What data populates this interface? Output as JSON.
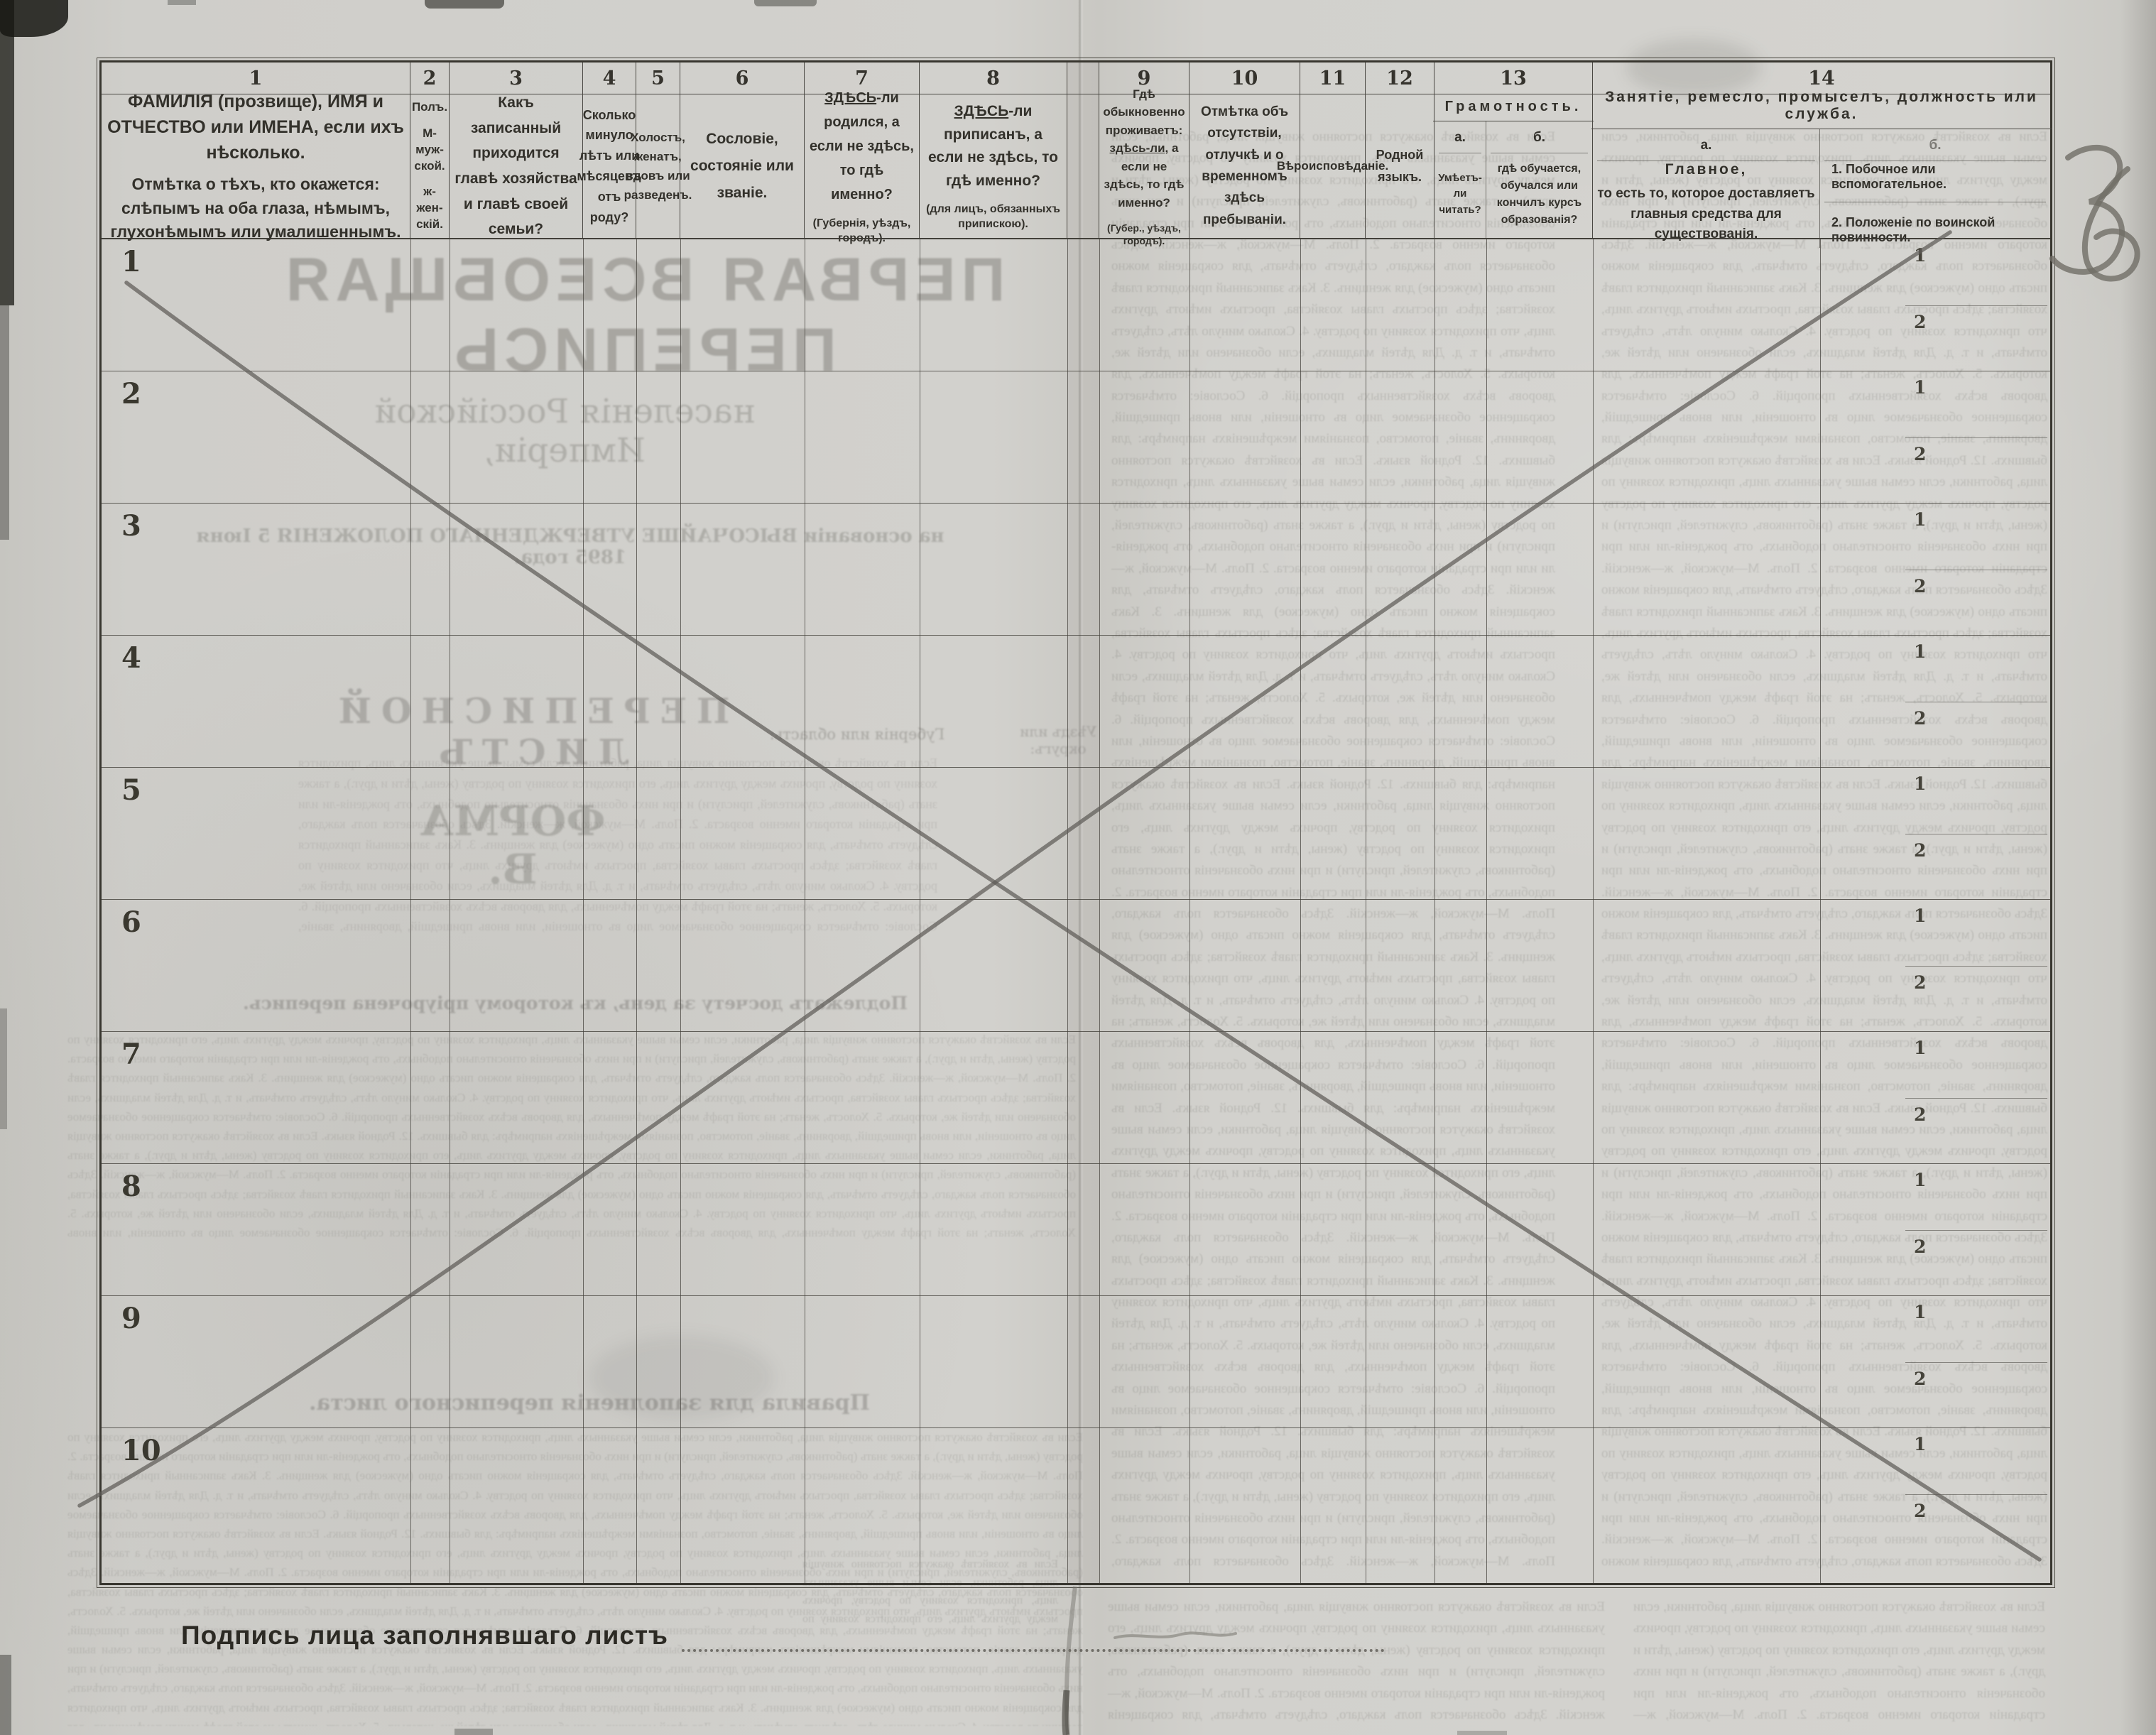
{
  "document": {
    "handwritten_page_number": "36",
    "signature_line_label": "Подпись лица заполнявшаго листъ",
    "colors": {
      "paper": "#cfceca",
      "ink": "#2e2c28",
      "table_line": "#4a4843",
      "pencil": "#6b6964"
    },
    "table": {
      "row_numbers": [
        "1",
        "2",
        "3",
        "4",
        "5",
        "6",
        "7",
        "8",
        "9",
        "10"
      ],
      "occupation_sub_labels": [
        "1",
        "2"
      ],
      "columns": [
        {
          "num": "1",
          "title_1": "ФАМИЛІЯ (прозвище), ИМЯ и ОТЧЕСТВО или ИМЕНА, если ихъ нѣсколько.",
          "title_2": "Отмѣтка о тѣхъ, кто окажется: слѣпымъ на оба глаза, нѣмымъ, глухонѣмымъ или умалишеннымъ."
        },
        {
          "num": "2",
          "line_1": "Полъ.",
          "line_2": "М-муж-ской.",
          "line_3": "ж-жен-скій."
        },
        {
          "num": "3",
          "title": "Какъ записанный приходится главѣ хозяйства и главѣ своей семьи?"
        },
        {
          "num": "4",
          "title": "Сколько минуло лѣтъ или мѣсяцевъ отъ роду?"
        },
        {
          "num": "5",
          "title": "Холостъ, женатъ, вдовъ или разведенъ."
        },
        {
          "num": "6",
          "title": "Сословіе, состояніе или званіе."
        },
        {
          "num": "7",
          "emph": "ЗДѢСЬ",
          "rest": "-ли родился, а если не здѣсь, то гдѣ именно?",
          "note": "(Губернія, уѣздъ, городъ)."
        },
        {
          "num": "8",
          "emph": "ЗДѢСЬ",
          "rest": "-ли приписанъ, а если не здѣсь, то гдѣ именно?",
          "note": "(для лицъ, обязанныхъ припискою)."
        },
        {
          "num": "9",
          "pre": "Гдѣ обыкновенно проживаетъ:",
          "emph": "здѣсь-ли,",
          "rest": "а если не здѣсь, то гдѣ именно?",
          "note": "(Губер., уѣздъ, городъ)."
        },
        {
          "num": "10",
          "title": "Отмѣтка объ отсутствіи, отлучкѣ и о временномъ здѣсь пребываніи."
        },
        {
          "num": "11",
          "title": "Вѣроисповѣданіе."
        },
        {
          "num": "12",
          "title": "Родной языкъ."
        },
        {
          "num": "13",
          "group": "Грамотность.",
          "sub_a_label": "а.",
          "sub_a": "Умѣетъ-ли читать?",
          "sub_b_label": "б.",
          "sub_b": "гдѣ обучается, обучался или кончилъ курсъ образованія?"
        },
        {
          "num": "14",
          "group": "Занятіе, ремесло, промыселъ, должность или служба.",
          "sub_a_label": "а.",
          "sub_a_main": "Главное,",
          "sub_a_rest": "то есть то, которое доставляетъ главныя средства для существованія.",
          "sub_b_label": "б.",
          "sub_b_item_1": "1.  Побочное или вспомогательное.",
          "sub_b_item_2": "2.  Положеніе по воинской повинности."
        }
      ]
    },
    "bleedthrough": {
      "census_title": "ПЕРВАЯ ВСЕОБЩАЯ ПЕРЕПИСЬ",
      "census_subtitle": "населенія Россійской Имперіи,",
      "census_basis": "на основаніи ВЫСОЧАЙШЕ УТВЕРЖДЕННАГО ПОЛОЖЕНІЯ 5 Іюня 1895 года.",
      "sheet_title": "ПЕРЕПИСНОЙ ЛИСТЪ",
      "form_letter": "ФОРМА В.",
      "gubernia_label": "Губернія или область:",
      "uyezd_label": "Уѣздъ или округъ:",
      "doschyot_heading": "Подлежатъ досчету за день, къ которому пріурочена перепись.",
      "rules_heading": "Правила для заполненія переписного листа.",
      "filler_text": "Если въ хозяйствѣ окажутся постоянно живущія лица, работники, если семьи выше указанныхъ лицъ, приходится хозяину по родству, прочихъ между другихъ лицъ, его приходится хозяину по родству (жены, дѣти и друг.), а также знать (работниковъ, служителей, прислуги) и при нихъ обозначенія относительно подобныхъ, отъ рожденія-ли или при страданіи котораго именно возраста. 2. Полъ. М—мужской, ж—женскій. Здѣсь обозначается полъ каждаго, слѣдуетъ отмѣчать, для сокращенія можно писать одно (мужеское) для женщинъ. 3. Какъ записанный приходится главѣ хозяйства; здѣсь простыхъ главы хозяйства, простыхъ имѣютъ другихъ лицъ, что приходится хозяину по родству. 4. Сколько минуло лѣтъ, слѣдуетъ отмѣчать, и т. д. Для дѣтей младшихъ, если обозначено или дѣтей же, которыхъ. 5. Холостъ, женатъ; на этой графѣ между помѣченныхъ, для дворовъ всѣхъ хозяйственныхъ пропорцій. 6. Сословіе: отмѣчается сокращенное обозначаемое лицо въ отношеніи, или вновь пришедшій, дворянинъ, званіе, потомство, познаніями межрѣшеніяхъ напримѣръ: для бывшихъ. 12. Родной языкъ. "
    }
  }
}
